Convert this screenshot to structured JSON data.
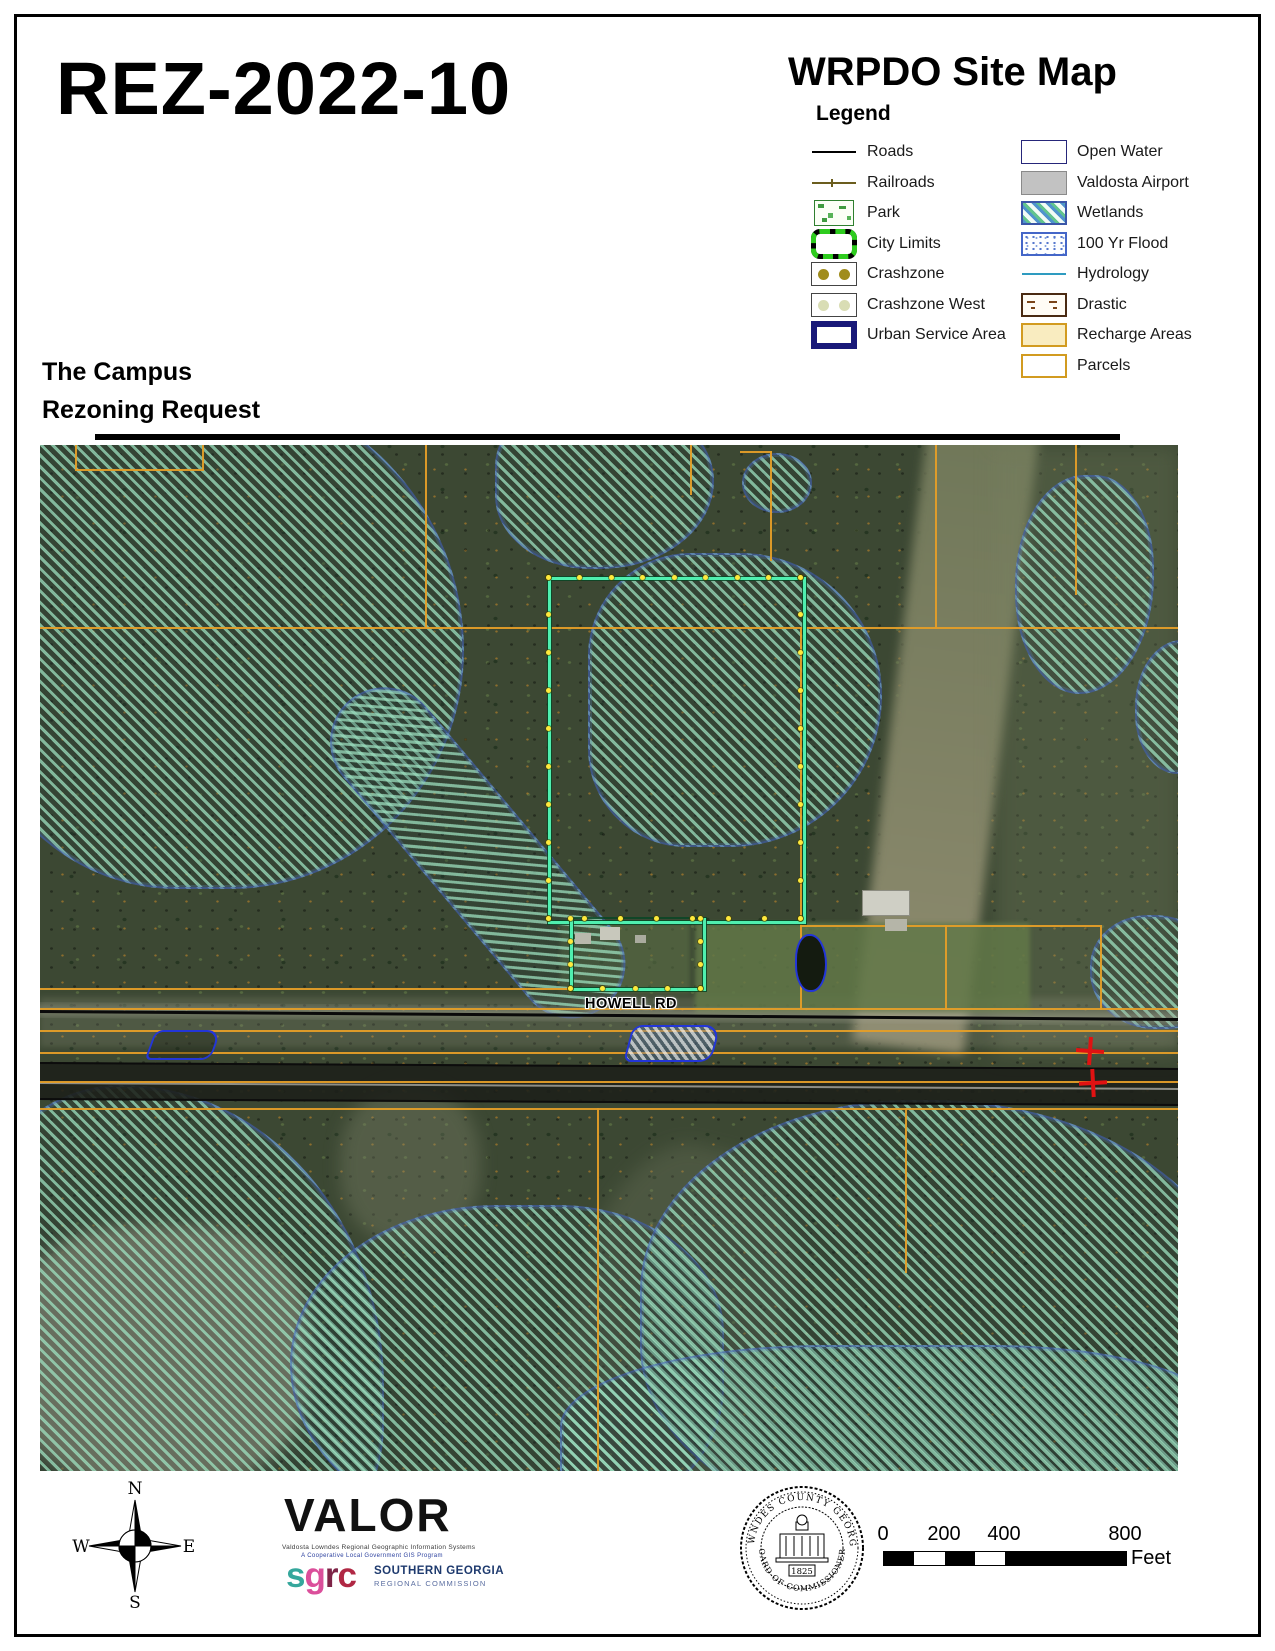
{
  "header": {
    "doc_id": "REZ-2022-10",
    "map_title": "WRPDO Site Map",
    "request_line1": "The Campus",
    "request_line2": "Rezoning Request"
  },
  "legend": {
    "heading": "Legend",
    "left_items": [
      {
        "label": "Roads",
        "type": "roads"
      },
      {
        "label": "Railroads",
        "type": "railroads"
      },
      {
        "label": "Park",
        "type": "park"
      },
      {
        "label": "City Limits",
        "type": "citylimits"
      },
      {
        "label": "Crashzone",
        "type": "crashzone"
      },
      {
        "label": "Crashzone West",
        "type": "crashzonewest"
      },
      {
        "label": "Urban Service Area",
        "type": "usa"
      }
    ],
    "right_items": [
      {
        "label": "Open Water",
        "type": "openwater"
      },
      {
        "label": "Valdosta Airport",
        "type": "airport"
      },
      {
        "label": "Wetlands",
        "type": "wetlands"
      },
      {
        "label": "100 Yr Flood",
        "type": "flood"
      },
      {
        "label": "Hydrology",
        "type": "hydrology"
      },
      {
        "label": "Drastic",
        "type": "drastic"
      },
      {
        "label": "Recharge Areas",
        "type": "recharge"
      },
      {
        "label": "Parcels",
        "type": "parcels"
      }
    ]
  },
  "map": {
    "road_label": "HOWELL RD"
  },
  "compass": {
    "n": "N",
    "e": "E",
    "s": "S",
    "w": "W"
  },
  "branding": {
    "valor": "VALOR",
    "tagline1": "Valdosta Lowndes Regional Geographic Information Systems",
    "tagline2": "A Cooperative Local Government GIS Program",
    "sgrc_s": "s",
    "sgrc_g": "g",
    "sgrc_r": "r",
    "sgrc_c": "c",
    "sgrc_line1": "SOUTHERN GEORGIA",
    "sgrc_line2": "REGIONAL COMMISSION"
  },
  "seal": {
    "arc_top": "LOWNDES COUNTY GEORGIA",
    "arc_bottom": "BOARD OF COMMISSIONERS",
    "year": "1825"
  },
  "scalebar": {
    "ticks": [
      "0",
      "200",
      "400",
      "800"
    ],
    "unit": "Feet"
  },
  "colors": {
    "parcel_line_orange": "#E49E28",
    "subject_parcel_green": "#4FEFAF",
    "wetland_edge_blue": "#4664B9",
    "urban_service_navy": "#191979",
    "recharge_yellow": "#F9ECC0",
    "hydrology_teal": "#2E9BC0",
    "crosshair_red": "#E01212"
  }
}
